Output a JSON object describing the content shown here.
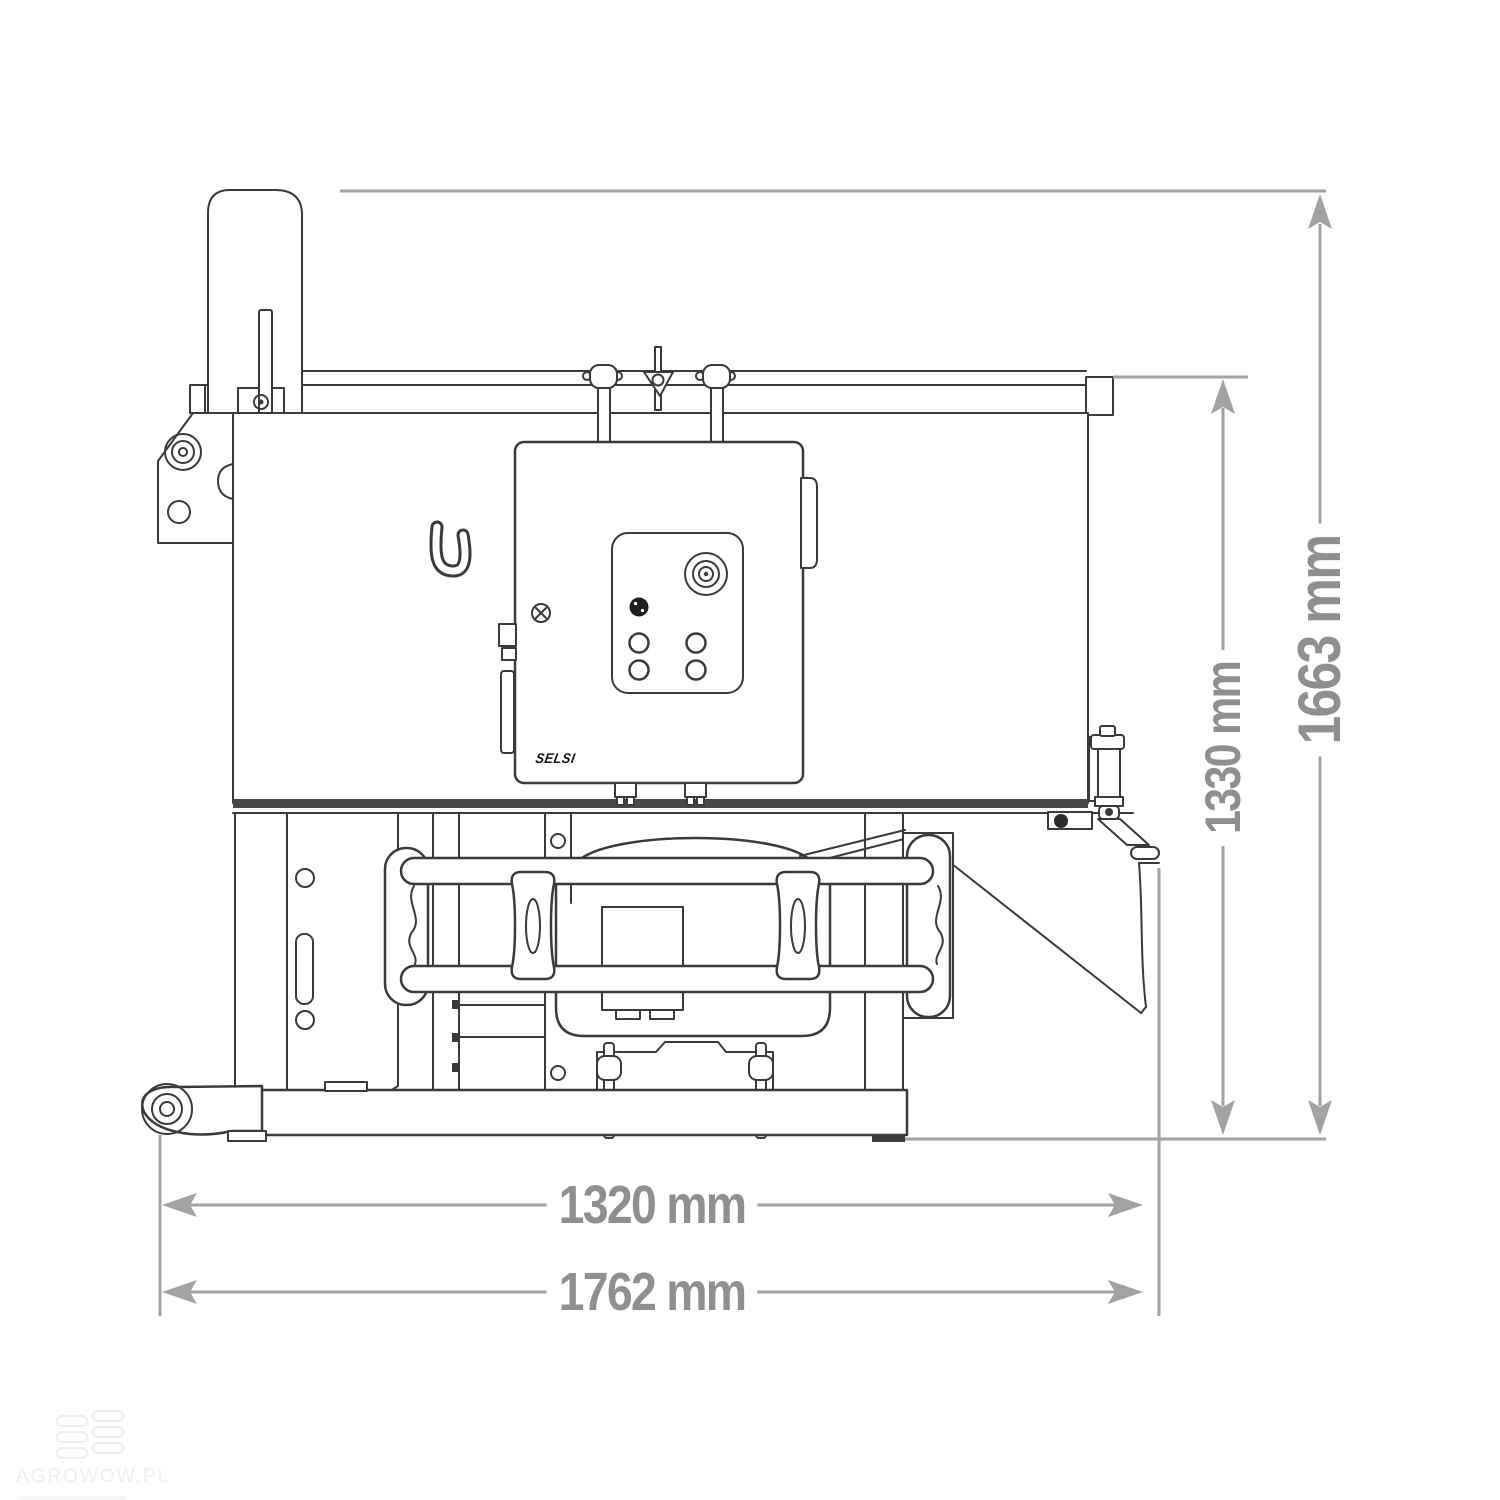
{
  "page": {
    "background_color": "#ffffff",
    "kind": "technical dimension drawing"
  },
  "drawing": {
    "subject": "tractor-mounted mixer, side elevation line drawing",
    "stroke_color": "#3a3a3a",
    "dimension_line_color": "#a2a2a2",
    "dimension_label_color": "#8f8f8f",
    "brand_label": "SELSI",
    "dimensions": [
      {
        "id": "inner-width",
        "label": "1320 mm",
        "value": 1320,
        "unit": "mm",
        "orientation": "horizontal"
      },
      {
        "id": "overall-width",
        "label": "1762 mm",
        "value": 1762,
        "unit": "mm",
        "orientation": "horizontal"
      },
      {
        "id": "inner-height",
        "label": "1330 mm",
        "value": 1330,
        "unit": "mm",
        "orientation": "vertical"
      },
      {
        "id": "overall-height",
        "label": "1663 mm",
        "value": 1663,
        "unit": "mm",
        "orientation": "vertical"
      }
    ]
  },
  "watermark": {
    "text": "AGROWOW.PL",
    "logo": "stacked-bars-icon",
    "text_color": "#edefed",
    "logo_color": "#ebf2e9"
  }
}
